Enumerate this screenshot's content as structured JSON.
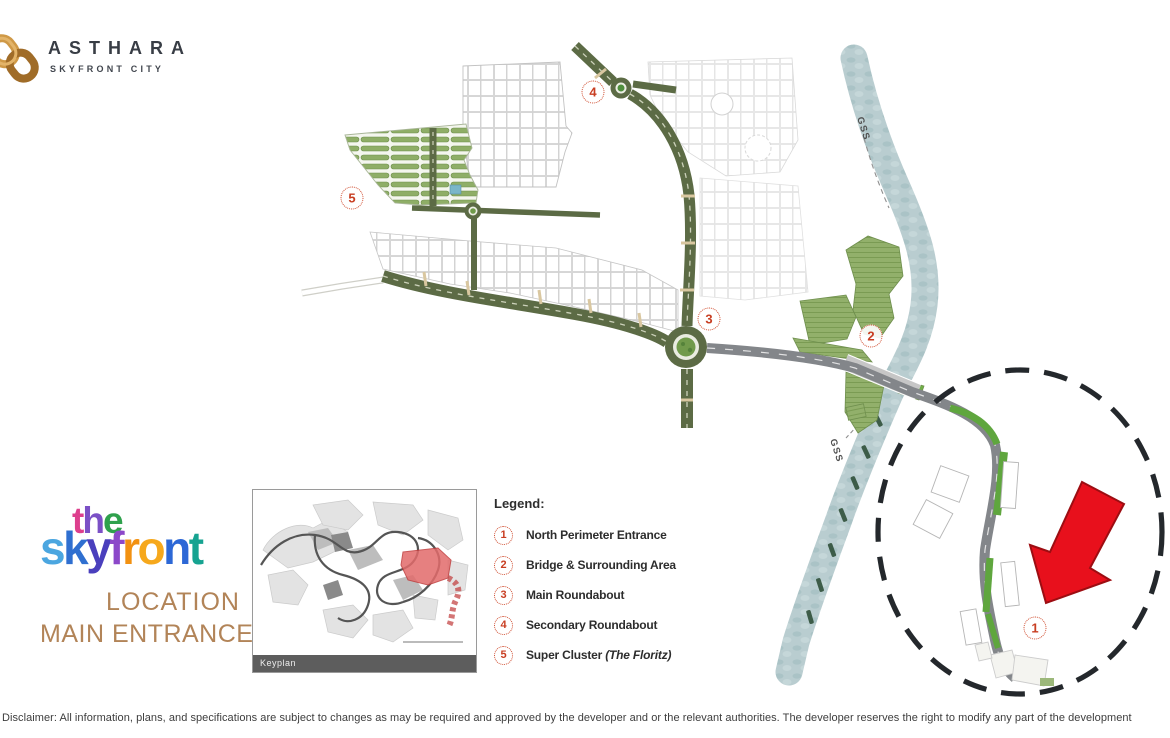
{
  "brand": {
    "name": "ASTHARA",
    "tagline": "SKYFRONT CITY"
  },
  "project": {
    "the_letters": [
      "t",
      "h",
      "e"
    ],
    "skyfront_letters": [
      "s",
      "k",
      "y",
      "f",
      "r",
      "o",
      "n",
      "t"
    ],
    "subtitle_line1": "LOCATION",
    "subtitle_line2": "MAIN ENTRANCE"
  },
  "legend": {
    "title": "Legend:",
    "items": [
      {
        "num": "1",
        "label": "North Perimeter Entrance",
        "note": ""
      },
      {
        "num": "2",
        "label": "Bridge & Surrounding Area",
        "note": ""
      },
      {
        "num": "3",
        "label": "Main Roundabout",
        "note": ""
      },
      {
        "num": "4",
        "label": "Secondary Roundabout",
        "note": ""
      },
      {
        "num": "5",
        "label": "Super Cluster ",
        "note": "(The Floritz)"
      }
    ]
  },
  "map": {
    "river_label": "GSS",
    "river_label_2": "GSS"
  },
  "keyplan": {
    "caption": "Keyplan"
  },
  "disclaimer": {
    "text": "Disclaimer: All information, plans, and specifications are subject to changes as may be required and approved by the developer and or the relevant authorities. The developer reserves the right to modify any part of the development"
  },
  "colors": {
    "accent_red": "#cf4a2c",
    "road_olive": "#5c6b45",
    "road_gray": "#83868a",
    "river": "#b9cdd0",
    "arrow_red": "#e8101c",
    "brand_gold": "#c08a3e",
    "subtitle_tan": "#b28458"
  }
}
